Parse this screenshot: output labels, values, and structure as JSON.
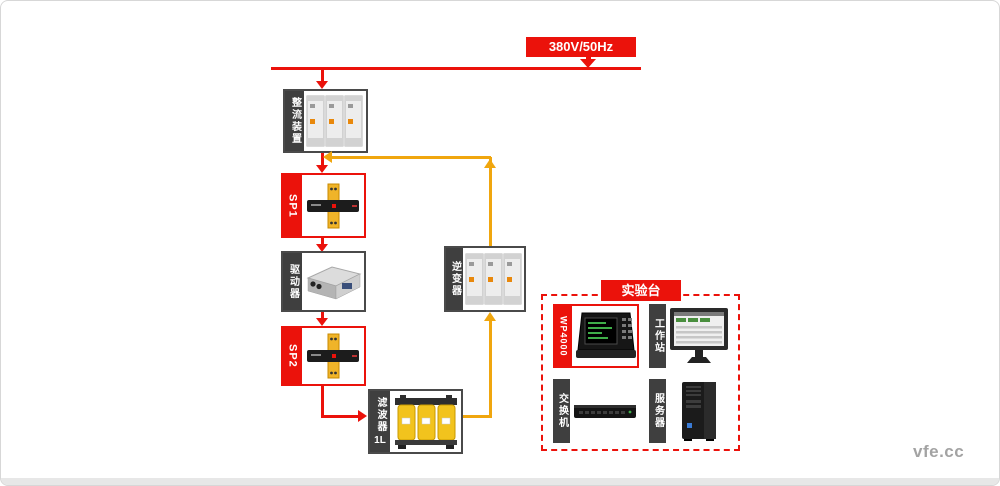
{
  "power": {
    "label": "380V/50Hz"
  },
  "blocks": {
    "rectifier": {
      "label": "整流装置"
    },
    "sp1": {
      "label": "SP1"
    },
    "driver": {
      "label": "驱动器"
    },
    "sp2": {
      "label": "SP2"
    },
    "filter": {
      "label": "滤波器",
      "sub": "1L"
    },
    "inverter": {
      "label": "逆变器"
    }
  },
  "bench": {
    "title": "实验台",
    "items": [
      {
        "id": "wp4000",
        "label": "WP4000"
      },
      {
        "id": "workstation",
        "label": "工作站"
      },
      {
        "id": "switch",
        "label": "交换机"
      },
      {
        "id": "server",
        "label": "服务器"
      }
    ]
  },
  "watermark": "vfe.cc",
  "colors": {
    "line_red": "#eb120b",
    "line_yellow": "#f0a60e",
    "strip_dark": "#3f3f3f"
  }
}
